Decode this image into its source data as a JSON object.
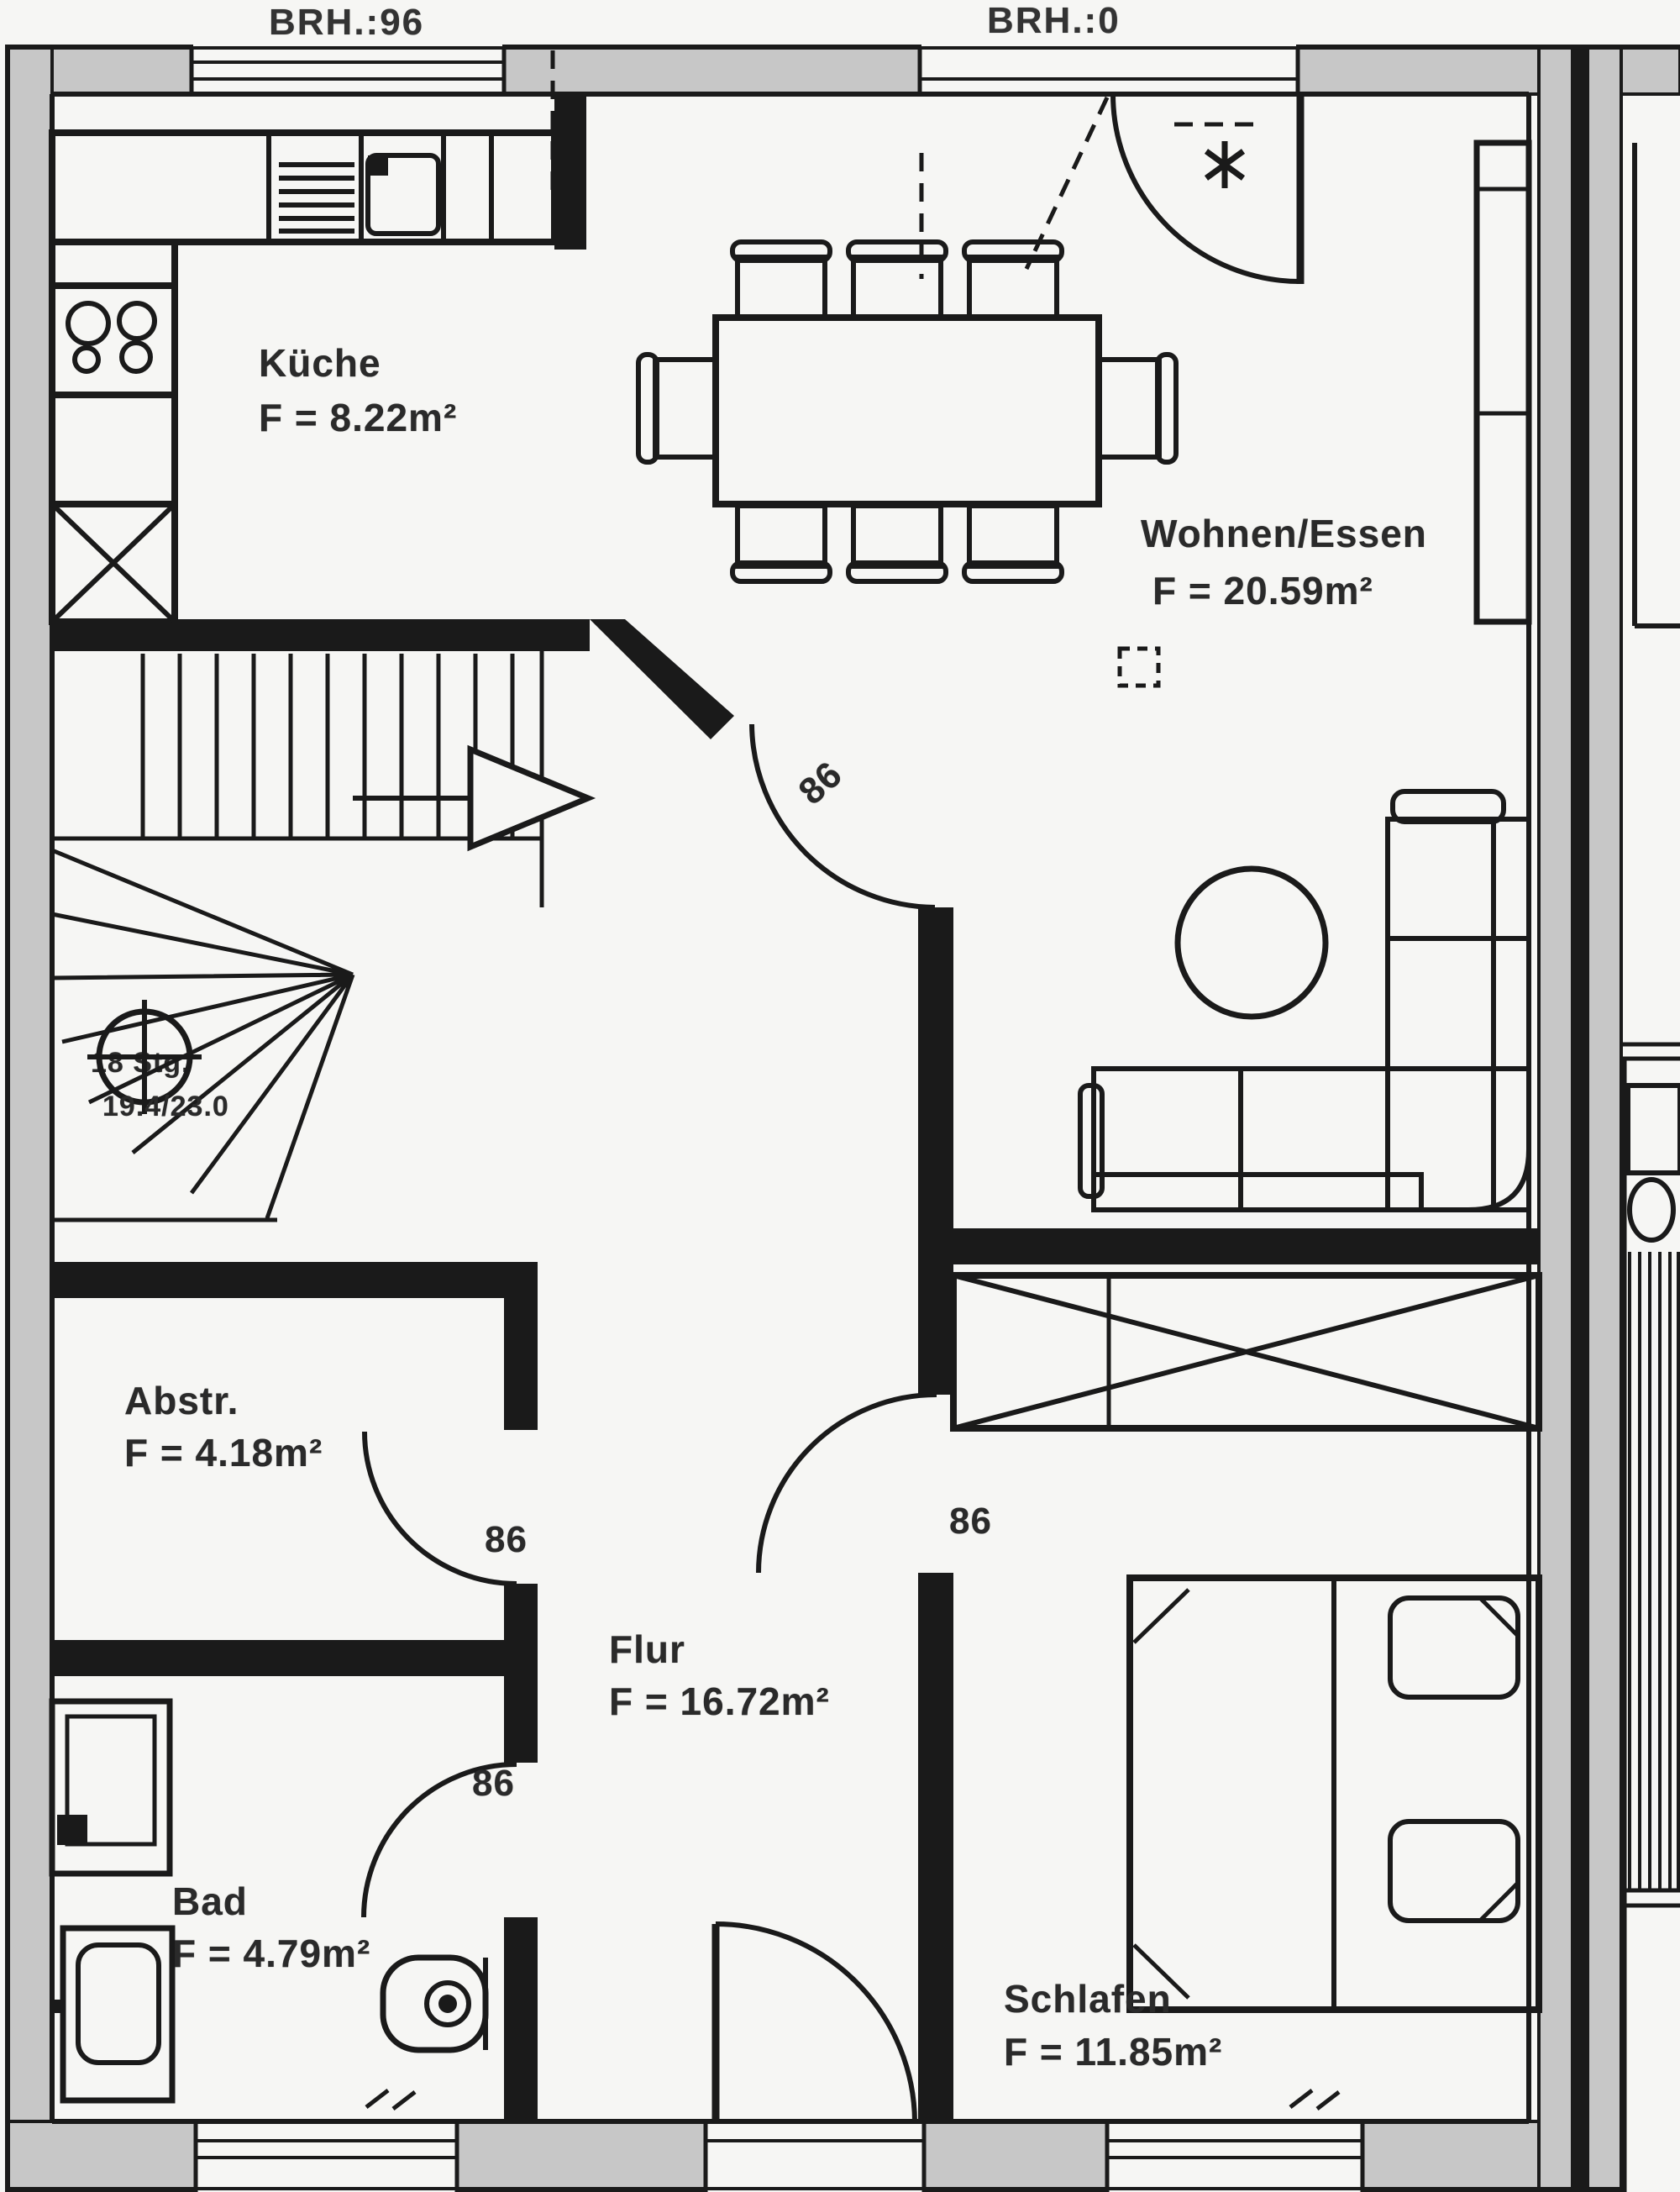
{
  "plan": {
    "annotations": {
      "brh_left": "BRH.:96",
      "brh_right": "BRH.:0"
    },
    "rooms": [
      {
        "id": "kueche",
        "name": "Küche",
        "area": "F = 8.22m²"
      },
      {
        "id": "wohnen",
        "name": "Wohnen/Essen",
        "area": "F = 20.59m²"
      },
      {
        "id": "abstr",
        "name": "Abstr.",
        "area": "F = 4.18m²"
      },
      {
        "id": "flur",
        "name": "Flur",
        "area": "F = 16.72m²"
      },
      {
        "id": "bad",
        "name": "Bad",
        "area": "F = 4.79m²"
      },
      {
        "id": "schlafen",
        "name": "Schlafen",
        "area": "F = 11.85m²"
      }
    ],
    "stairs": {
      "steps_label": "18 Stg.",
      "rise_run": "19.4/23.0"
    },
    "door_widths": {
      "hall_entry": "86",
      "storage": "86",
      "bedroom": "86",
      "bathroom": "86"
    },
    "colors": {
      "wall_fill": "#c7c7c7",
      "line": "#1a1a1a",
      "paper": "#f6f6f4"
    }
  }
}
